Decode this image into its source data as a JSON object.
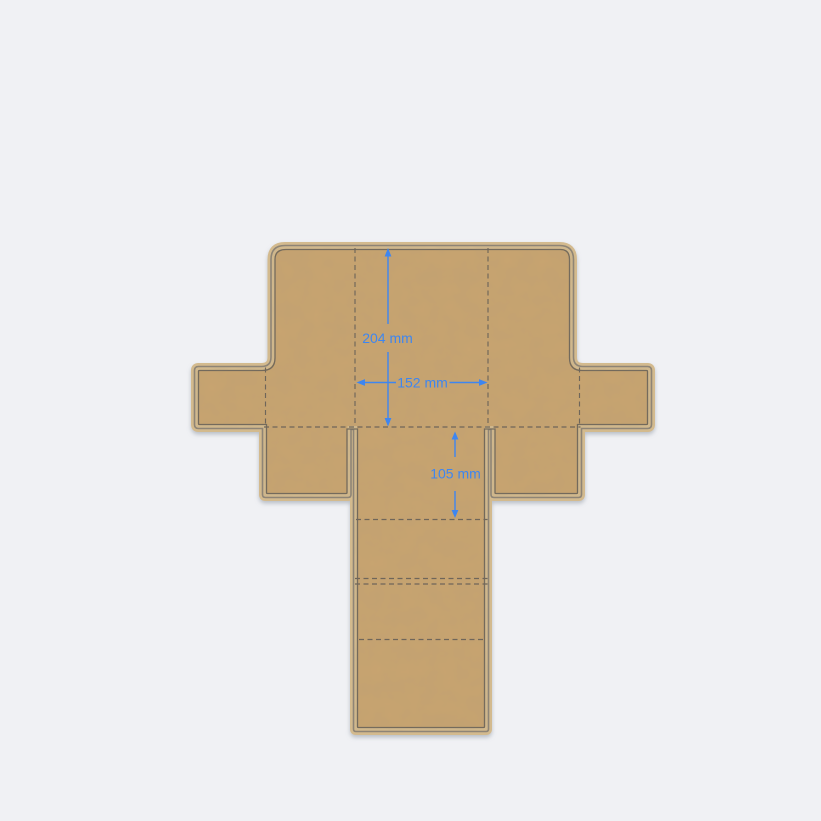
{
  "app": {
    "view": "dieline-preview-canvas",
    "background_color": "#f0f1f4"
  },
  "dieline": {
    "type": "folding-box-template",
    "material": "kraft",
    "material_color": "#c8a470",
    "edge_highlight_color": "#d3ba8e",
    "cut_line_color": "#8d8476",
    "inner_line_color": "#70675a",
    "fold_line_color": "#6f665a",
    "fold_line_style": "dashed",
    "dimension_color": "#3e86f0",
    "dimensions": [
      {
        "name": "length",
        "label": "204 mm",
        "value": 204,
        "unit": "mm",
        "orientation": "vertical"
      },
      {
        "name": "width",
        "label": "152 mm",
        "value": 152,
        "unit": "mm",
        "orientation": "horizontal"
      },
      {
        "name": "depth",
        "label": "105 mm",
        "value": 105,
        "unit": "mm",
        "orientation": "vertical"
      }
    ]
  }
}
